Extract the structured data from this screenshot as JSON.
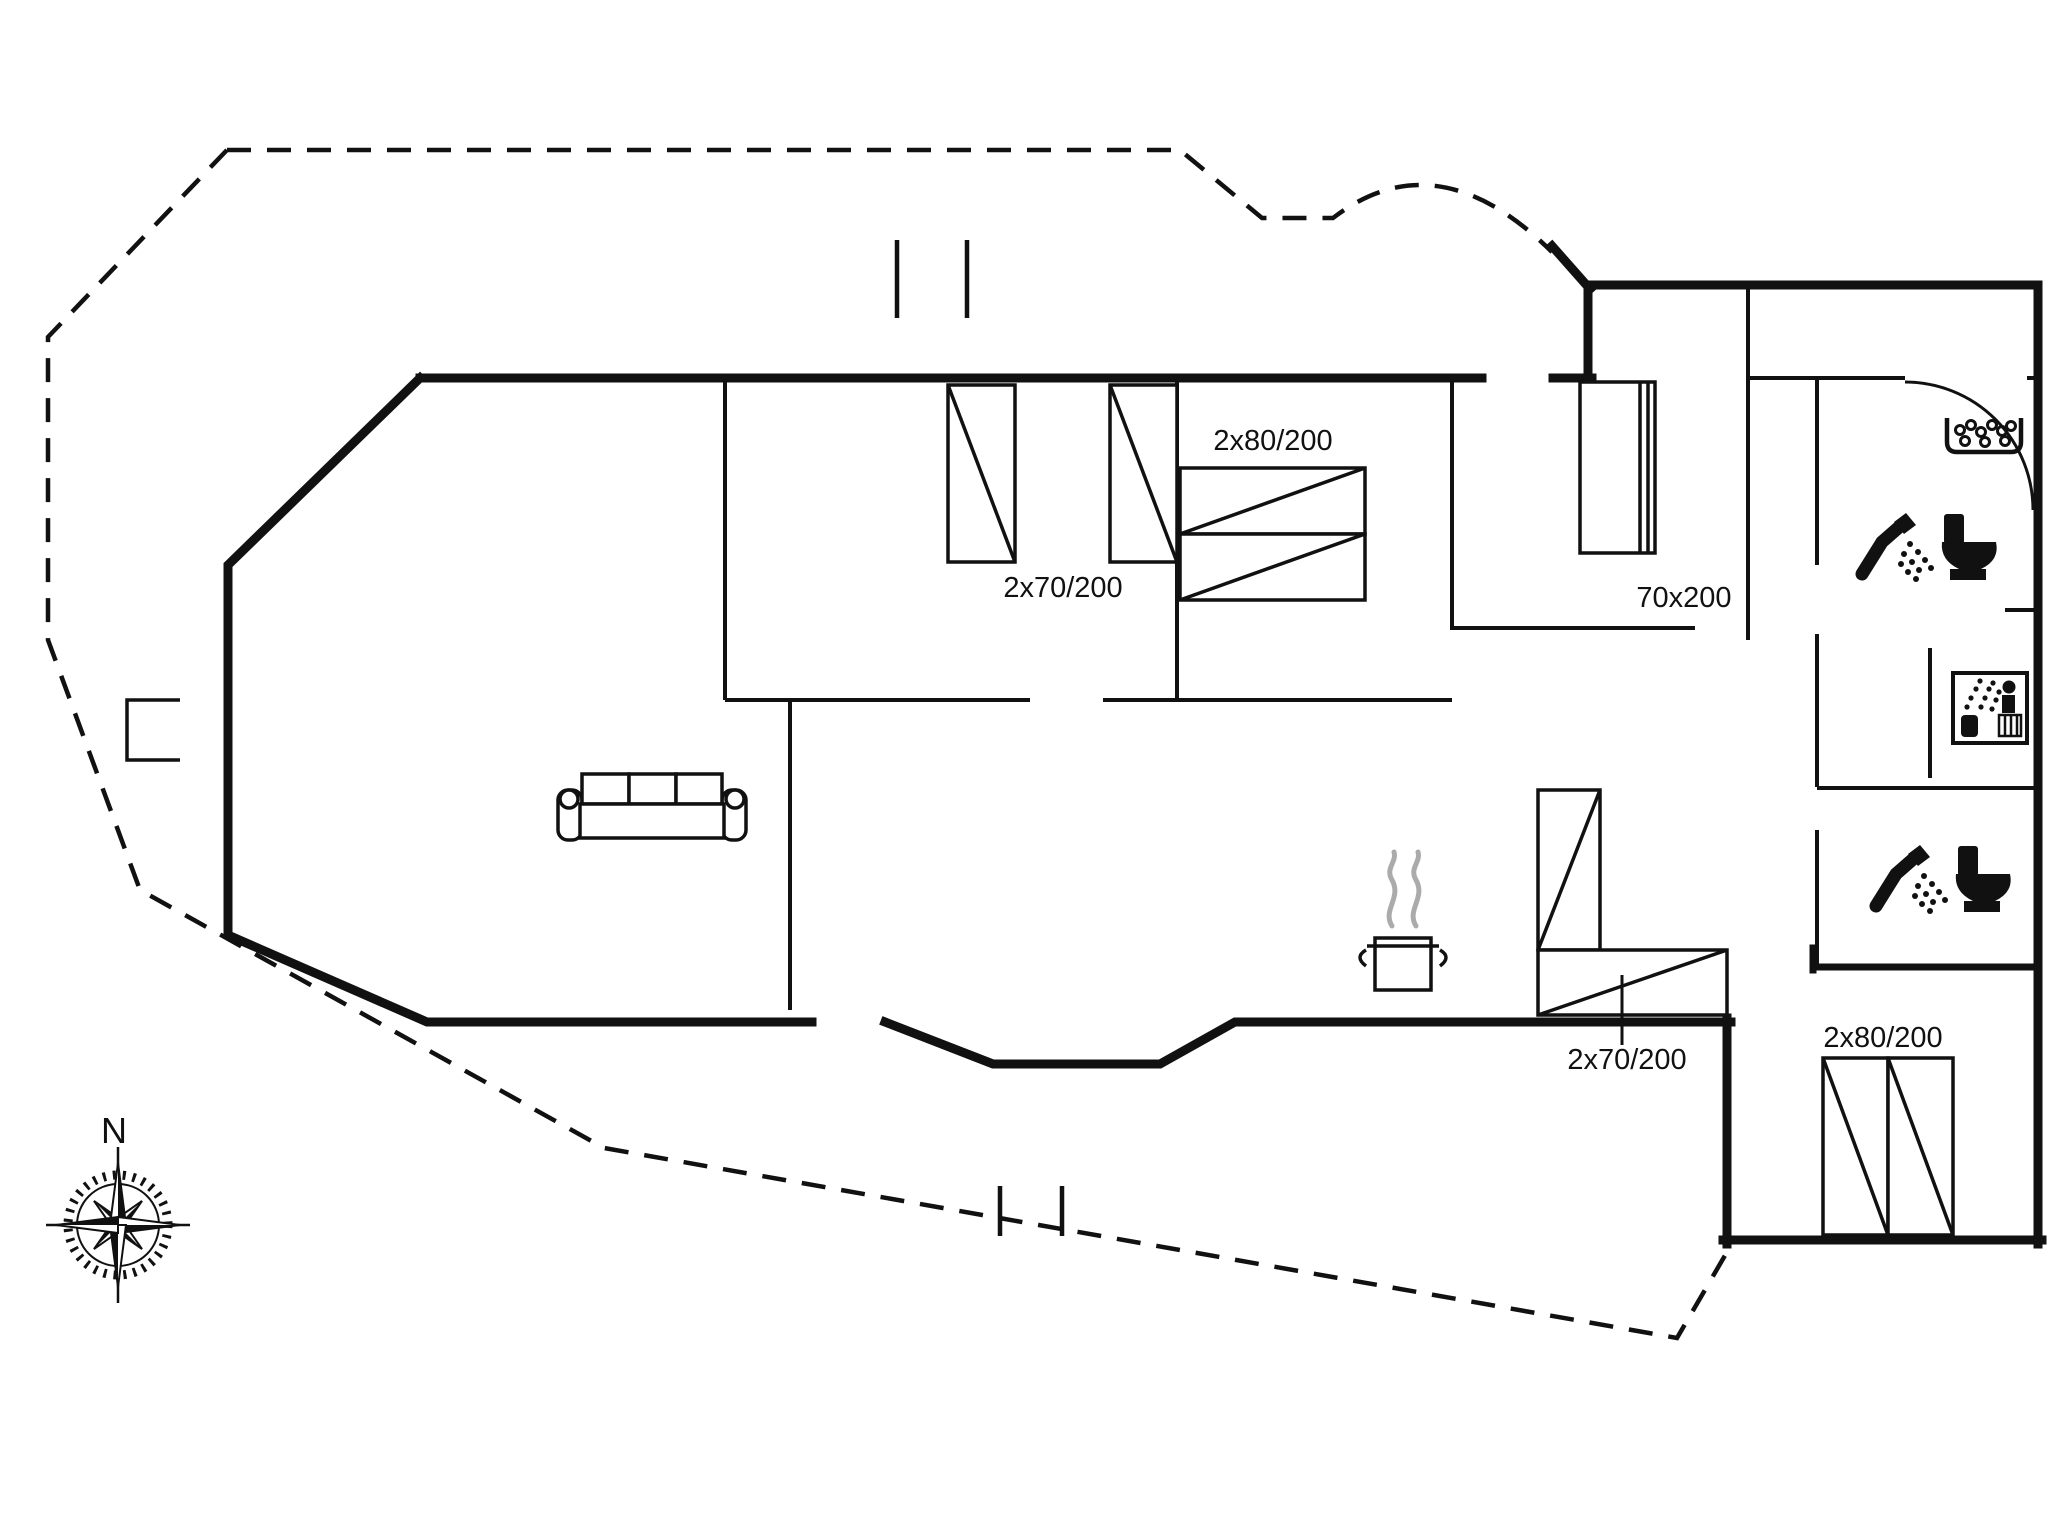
{
  "plan": {
    "type": "holiday-house-floor-plan",
    "background_color": "#ffffff",
    "wall_color": "#111111",
    "steam_color": "#ababab",
    "compass": {
      "north_label": "N"
    },
    "labels": {
      "bedroom1_beds": "2x70/200",
      "bedroom2_bed": "2x80/200",
      "entry_bed": "70x200",
      "kitchen_bunk": "2x70/200",
      "bunkroom_bed": "2x80/200"
    },
    "icons": [
      "compass-rose-icon",
      "sofa-icon",
      "cooking-pot-icon",
      "steam-icon",
      "shower-toilet-icon",
      "sink-bubbles-icon",
      "sauna-icon",
      "door-swing-icon",
      "window-mark-icon",
      "bed-symbol",
      "bunk-bed-symbol",
      "wardrobe-symbol"
    ]
  }
}
